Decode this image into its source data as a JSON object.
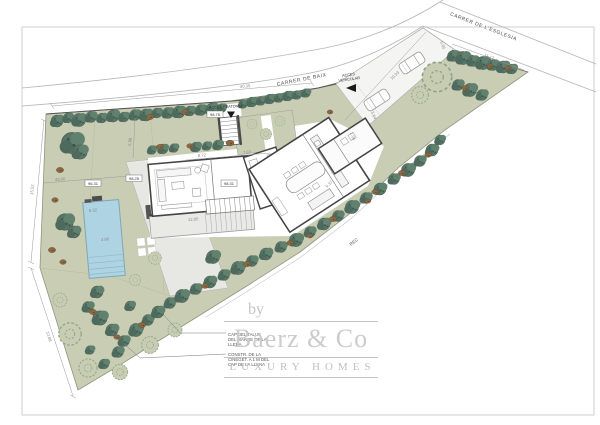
{
  "plan": {
    "streets": {
      "baix": "CARRER DE BAIX",
      "esglesia": "CARRER DE L'ESGLESIA"
    },
    "access": {
      "pedestrian": "ACCES PEATONAL",
      "vehicular_line1": "ACCES",
      "vehicular_line2": "VEHICULAR"
    },
    "waterway": "REC",
    "levels": {
      "access": "98.75",
      "hall": "98.31",
      "terrace": "98.25",
      "poolside": "96.31"
    },
    "dims": {
      "top": "40.35",
      "esglesia": "11.12",
      "driveway": "10.93",
      "d505": "5.05",
      "d364": "3.64",
      "d206": "2.06",
      "left": "15.52",
      "bottomleft": "12.88",
      "d4300": "43.00",
      "d1285": "12.85",
      "d432": "4.32",
      "d937": "9.37",
      "d872": "8.72",
      "d763": "7.63",
      "d598": "5.98",
      "pool_l": "8.22",
      "pool_w": "3.86"
    },
    "notes": {
      "n1l1": "CAP DEL TALUS",
      "n1l2": "DEL MARGE DE LA",
      "n1l3": "LLERA",
      "n2l1": "CONSTR. DE LA",
      "n2l2": "CINEGET. A 1 M DEL",
      "n2l3": "CAP DE LA LLERA"
    }
  },
  "watermark": {
    "by": "by",
    "brand": "Baerz & Co",
    "tagline": "LUXURY HOMES"
  },
  "colors": {
    "garden": "#c9cdb4",
    "tree": "#587668",
    "shrub": "#8a6843",
    "pool": "#aed3e3",
    "wall": "#444444",
    "watermark": "#c9c9c9"
  }
}
